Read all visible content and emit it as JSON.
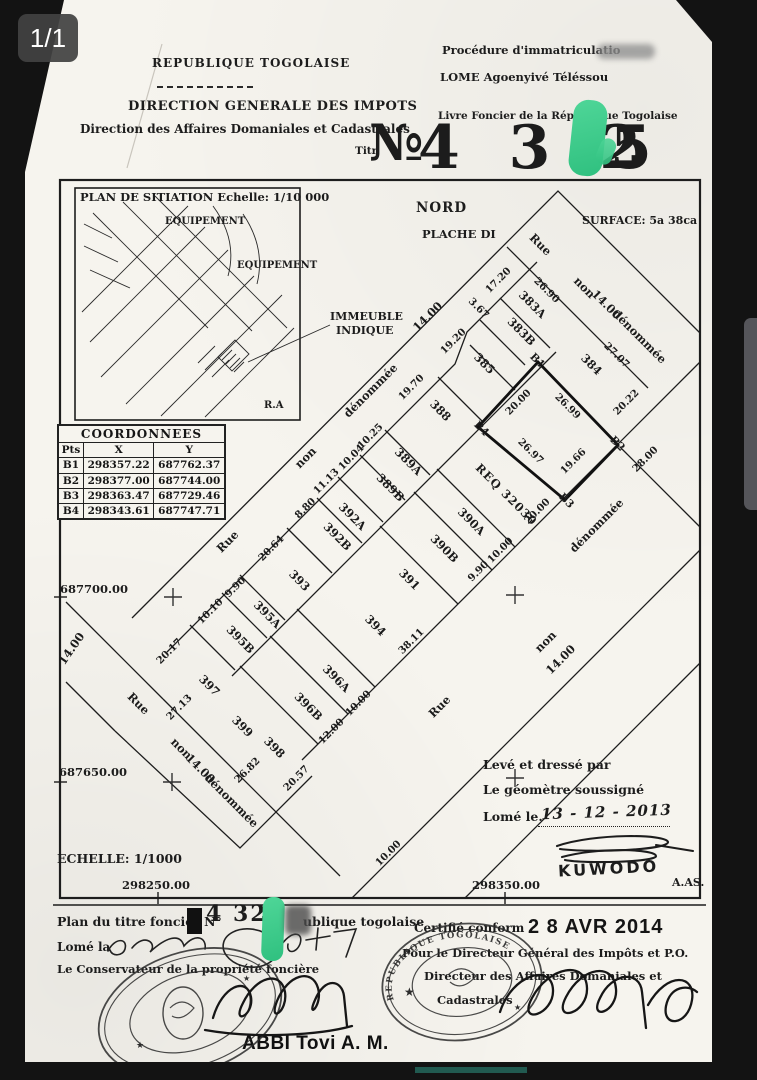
{
  "viewer": {
    "page_indicator": "1/1"
  },
  "header": {
    "republic": "REPUBLIQUE TOGOLAISE",
    "direction": "DIRECTION GENERALE DES IMPOTS",
    "subdirection": "Direction des Affaires Domaniales et Cadastrales",
    "procedure": "Procédure d'immatriculatio",
    "location": "LOME Agoenyivé Téléssou",
    "livre": "Livre Foncier de la République Togolaise",
    "titre_label": "Titr",
    "numero_prefix": "№",
    "numero_left": "4 3 2",
    "numero_right": "5"
  },
  "situation": {
    "title": "PLAN DE SITIATION Echelle: 1/10 000",
    "equipement1": "EQUIPEMENT",
    "equipement2": "EQUIPEMENT",
    "ra": "R.A",
    "immeuble1": "IMMEUBLE",
    "immeuble2": "INDIQUE"
  },
  "compass": {
    "nord": "NORD",
    "planche": "PLACHE DI"
  },
  "surface": "SURFACE: 5a 38ca",
  "coords": {
    "title": "COORDONNEES",
    "headers": [
      "Pts",
      "X",
      "Y"
    ],
    "rows": [
      [
        "B1",
        "298357.22",
        "687762.37"
      ],
      [
        "B2",
        "298377.00",
        "687744.00"
      ],
      [
        "B3",
        "298363.47",
        "687729.46"
      ],
      [
        "B4",
        "298343.61",
        "687747.71"
      ]
    ]
  },
  "plan": {
    "labels": [
      [
        "Rue",
        228,
        542,
        -45,
        "s"
      ],
      [
        "non",
        306,
        458,
        -45,
        "s"
      ],
      [
        "dénommée",
        371,
        391,
        -45,
        "s"
      ],
      [
        "Rue",
        540,
        245,
        45,
        "s"
      ],
      [
        "non",
        584,
        288,
        45,
        "s"
      ],
      [
        "14.00",
        606,
        305,
        45,
        "s"
      ],
      [
        "dénommée",
        639,
        337,
        45,
        "s"
      ],
      [
        "Rue",
        138,
        704,
        45,
        "s"
      ],
      [
        "non",
        181,
        749,
        45,
        "s"
      ],
      [
        "14.00",
        200,
        769,
        45,
        "s"
      ],
      [
        "dénommée",
        231,
        801,
        45,
        "s"
      ],
      [
        "Rue",
        440,
        707,
        -45,
        "s"
      ],
      [
        "non",
        546,
        642,
        -45,
        "s"
      ],
      [
        "14.00",
        561,
        660,
        -45,
        "s"
      ],
      [
        "dénommée",
        597,
        526,
        -45,
        "s"
      ],
      [
        "14.00",
        72,
        649,
        -55,
        "s"
      ],
      [
        "14.00",
        428,
        317,
        -45,
        "s"
      ],
      [
        "19.20",
        454,
        342,
        -45,
        "d"
      ],
      [
        "19.70",
        412,
        388,
        -45,
        "d"
      ],
      [
        "10.25",
        371,
        437,
        -45,
        "d"
      ],
      [
        "10.04",
        352,
        458,
        -45,
        "d"
      ],
      [
        "11.13",
        327,
        482,
        -45,
        "d"
      ],
      [
        "8.80",
        306,
        509,
        -45,
        "d"
      ],
      [
        "20.64",
        272,
        549,
        -45,
        "d"
      ],
      [
        "9.90",
        236,
        588,
        -45,
        "d"
      ],
      [
        "10.10",
        211,
        612,
        -45,
        "d"
      ],
      [
        "20.17",
        170,
        652,
        -45,
        "d"
      ],
      [
        "27.13",
        180,
        708,
        -45,
        "d"
      ],
      [
        "17.20",
        499,
        281,
        -45,
        "d"
      ],
      [
        "3.67",
        478,
        309,
        45,
        "d"
      ],
      [
        "26.90",
        546,
        291,
        45,
        "d"
      ],
      [
        "27.07",
        616,
        356,
        45,
        "d"
      ],
      [
        "20.22",
        627,
        403,
        -45,
        "d"
      ],
      [
        "28.00",
        646,
        460,
        -45,
        "d"
      ],
      [
        "20.00",
        519,
        403,
        -45,
        "d"
      ],
      [
        "26.99",
        567,
        407,
        45,
        "d"
      ],
      [
        "19.66",
        574,
        462,
        -45,
        "d"
      ],
      [
        "26.97",
        530,
        452,
        45,
        "d"
      ],
      [
        "20.00",
        538,
        512,
        -45,
        "d"
      ],
      [
        "10.00",
        501,
        551,
        -45,
        "d"
      ],
      [
        "9.90",
        479,
        572,
        -45,
        "d"
      ],
      [
        "38.11",
        412,
        642,
        -45,
        "d"
      ],
      [
        "10.00",
        359,
        704,
        -45,
        "d"
      ],
      [
        "12.00",
        332,
        732,
        -45,
        "d"
      ],
      [
        "20.57",
        297,
        779,
        -45,
        "d"
      ],
      [
        "26.82",
        248,
        771,
        -45,
        "d"
      ],
      [
        "10.00",
        389,
        854,
        -45,
        "d"
      ],
      [
        "B1",
        537,
        361,
        45,
        "p"
      ],
      [
        "B2",
        617,
        444,
        45,
        "p"
      ],
      [
        "B3",
        566,
        501,
        45,
        "p"
      ],
      [
        "B4",
        481,
        429,
        45,
        "p"
      ],
      [
        "383A",
        532,
        305,
        45,
        "l"
      ],
      [
        "383B",
        521,
        332,
        45,
        "l"
      ],
      [
        "385",
        484,
        364,
        45,
        "l"
      ],
      [
        "388",
        440,
        411,
        45,
        "l"
      ],
      [
        "389A",
        408,
        462,
        45,
        "l"
      ],
      [
        "389B",
        390,
        488,
        45,
        "l"
      ],
      [
        "392A",
        352,
        517,
        45,
        "l"
      ],
      [
        "392B",
        337,
        537,
        45,
        "l"
      ],
      [
        "393",
        299,
        581,
        45,
        "l"
      ],
      [
        "395A",
        267,
        615,
        45,
        "l"
      ],
      [
        "395B",
        240,
        640,
        45,
        "l"
      ],
      [
        "397",
        209,
        686,
        45,
        "l"
      ],
      [
        "399",
        242,
        727,
        45,
        "l"
      ],
      [
        "384",
        591,
        365,
        45,
        "l"
      ],
      [
        "390A",
        471,
        522,
        45,
        "l"
      ],
      [
        "390B",
        444,
        549,
        45,
        "l"
      ],
      [
        "391",
        409,
        580,
        45,
        "l"
      ],
      [
        "394",
        375,
        626,
        45,
        "l"
      ],
      [
        "396A",
        336,
        679,
        45,
        "l"
      ],
      [
        "396B",
        308,
        707,
        45,
        "l"
      ],
      [
        "398",
        274,
        748,
        45,
        "l"
      ],
      [
        "REQ 32030",
        506,
        495,
        45,
        "r"
      ]
    ]
  },
  "margins": {
    "y1": "687700.00",
    "y2": "687650.00",
    "x1": "298250.00",
    "x2": "298350.00",
    "echelle": "ECHELLE: 1/1000",
    "aas": "A.AS."
  },
  "surveyor": {
    "line1": "Levé et dressé par",
    "line2": "Le géomètre soussigné",
    "line3": "Lomé le.",
    "date": "13 - 12 - 2013",
    "name": "KUWODO"
  },
  "footer": {
    "plan_label": "Plan du titre foncier N°",
    "plan_number": "4 32",
    "plan_suffix": "ublique togolaise",
    "lome_la": "Lomé la",
    "conservateur": "Le Conservateur de la propriété foncière",
    "certifie": "Certifié conform",
    "date_stamp": "2 8 AVR  2014",
    "pour_line": "Pour le Directeur Général des Impôts et P.O.",
    "dir_line": "Directeur des Affaires Domaniales et",
    "cad_line": "Cadastrales",
    "signer": "ABBI Tovi A. M.",
    "stamp_text": "REPUBLIQUE TOGOLAISE"
  }
}
